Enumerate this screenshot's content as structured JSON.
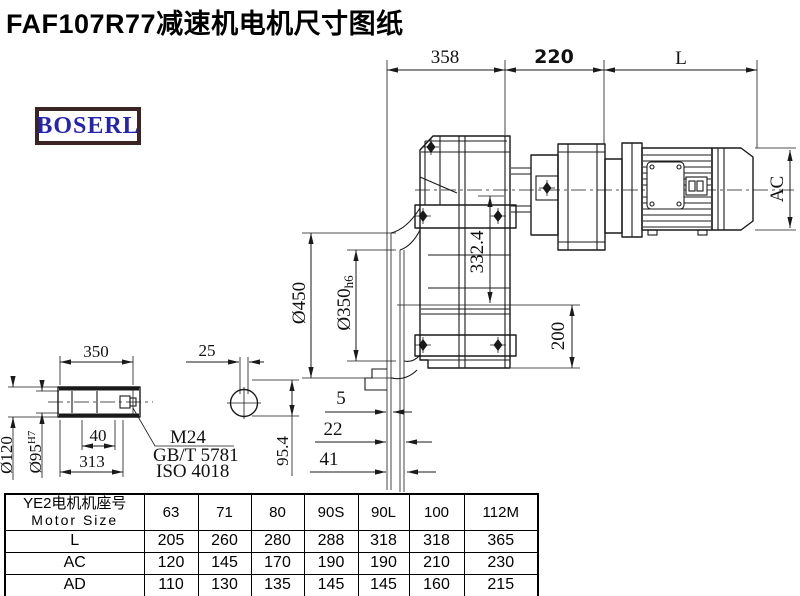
{
  "title": "FAF107R77减速机电机尺寸图纸",
  "brand": {
    "name": "BOSERL"
  },
  "drawing": {
    "dims": {
      "width_gear": "358",
      "width_adapter": "220",
      "width_motor": "L",
      "motor_height": "AC",
      "center_height": "332.4",
      "shaft_height": "200",
      "flange_od": "Ø450",
      "flange_spigot": "Ø350",
      "flange_spigot_tol": "h6",
      "hub_length": "350",
      "key_width": "25",
      "hub_od": "Ø120",
      "bore": "Ø95",
      "bore_tol": "H7",
      "bolt_recess": "40",
      "hub_inner_len": "313",
      "thread": "M24",
      "bolt_std_gb": "GB/T 5781",
      "bolt_std_iso": "ISO 4018",
      "key_section": "95.4",
      "offset_a": "5",
      "offset_b": "22",
      "offset_c": "41"
    }
  },
  "table": {
    "header_line1": "YE2电机机座号",
    "header_line2": "Motor Size",
    "columns": [
      "63",
      "71",
      "80",
      "90S",
      "90L",
      "100",
      "112M"
    ],
    "rows": [
      {
        "label": "L",
        "values": [
          "205",
          "260",
          "280",
          "288",
          "318",
          "318",
          "365"
        ]
      },
      {
        "label": "AC",
        "values": [
          "120",
          "145",
          "170",
          "190",
          "190",
          "210",
          "230"
        ]
      },
      {
        "label": "AD",
        "values": [
          "110",
          "130",
          "135",
          "145",
          "145",
          "160",
          "215"
        ]
      }
    ]
  }
}
